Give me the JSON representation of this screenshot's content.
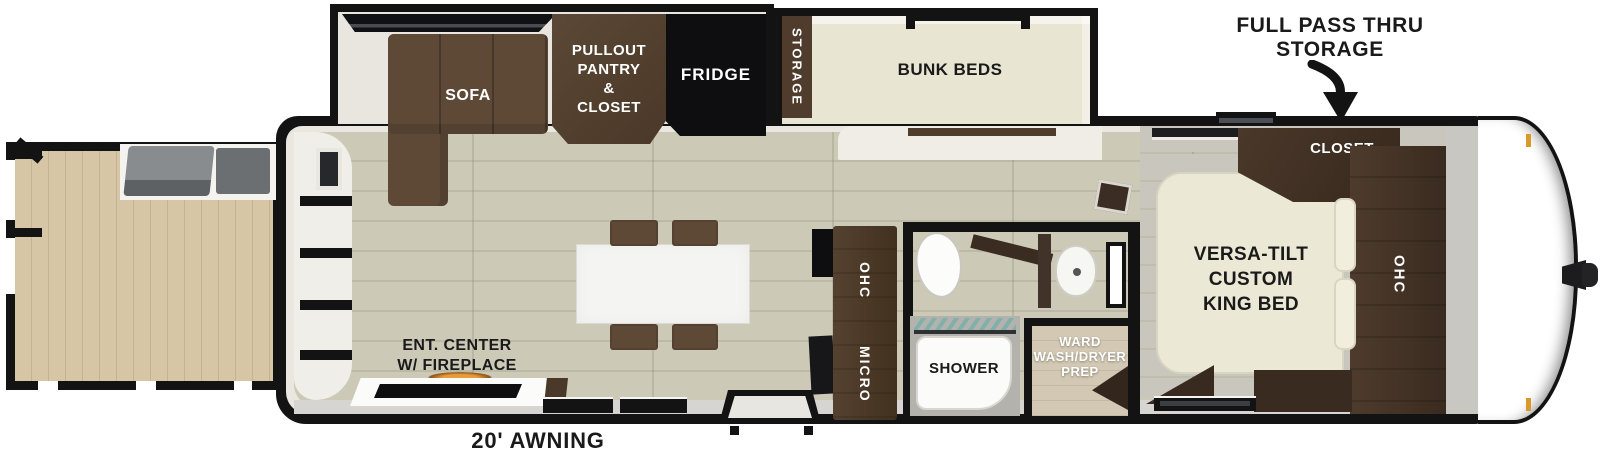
{
  "labels": {
    "full_pass_thru_line1": "FULL PASS THRU",
    "full_pass_thru_line2": "STORAGE",
    "awning": "20' AWNING"
  },
  "rooms": {
    "sofa": "SOFA",
    "pantry": [
      "PULLOUT",
      "PANTRY",
      "&",
      "CLOSET"
    ],
    "fridge": "FRIDGE",
    "storage": "STORAGE",
    "bunk_beds": "BUNK BEDS",
    "closet": "CLOSET",
    "king_bed": [
      "VERSA-TILT",
      "CUSTOM",
      "KING BED"
    ],
    "ohc_bedroom": "OHC",
    "ohc_kitchen": "OHC",
    "micro": "MICRO",
    "shower": "SHOWER",
    "ward": [
      "WARD",
      "WASH/DRYER",
      "PREP"
    ],
    "ent_center": [
      "ENT. CENTER",
      "W/ FIREPLACE"
    ]
  },
  "colors": {
    "wall": "#131313",
    "floor": "#cdc9b7",
    "floor_line": "#bdb9a7",
    "deck": "#d6c6a6",
    "deck_line": "#c4b292",
    "lining": "#e9e7e0",
    "slide_wall": "#e8e6de",
    "cream": "#e9e5d3",
    "bed": "#ece8d6",
    "bedroom_floor": "#c8c6bd",
    "cabinet": "#4f3c2d",
    "cabinet_dark": "#3a2b20",
    "sofa": "#5e4937",
    "black_appliance": "#0e0e10",
    "band": "#d6d5d1",
    "front_gray": "#c9c7c2",
    "shower_gray": "#b4b2ac",
    "ward_floor": "#d2c8b3",
    "tub": "#fbfbf9",
    "amber": "#d99a2b",
    "teal": "#7fb0aa"
  }
}
